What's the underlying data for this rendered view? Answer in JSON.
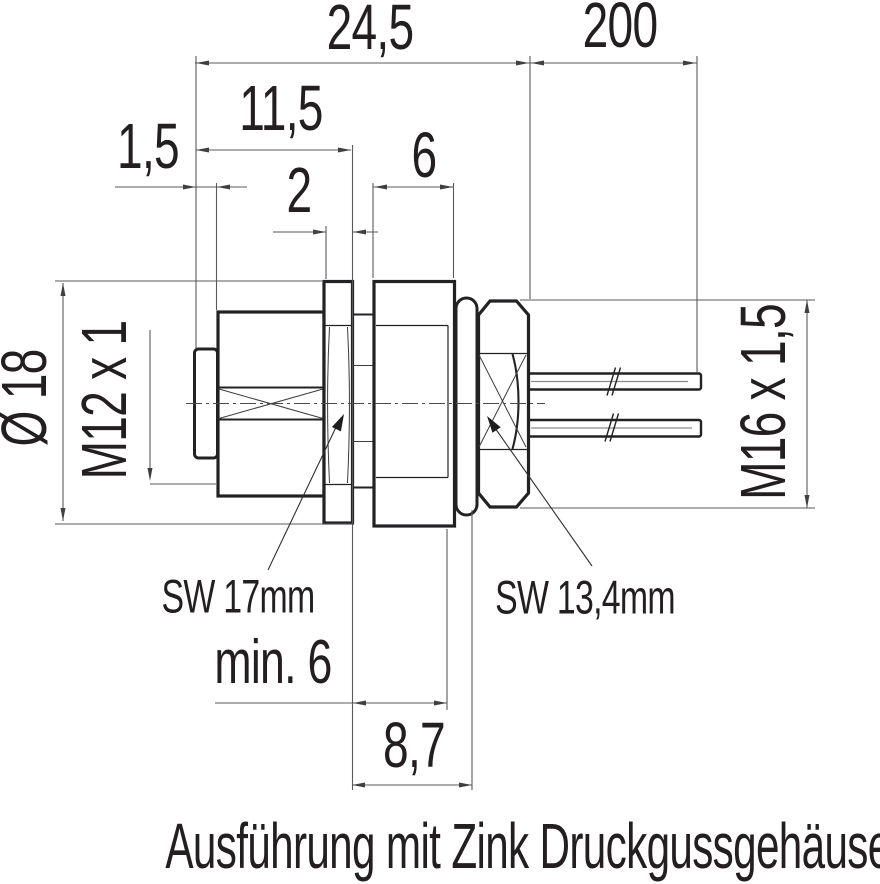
{
  "caption": "Ausführung mit Zink Druckgussgehäuse",
  "labels": {
    "overall_length": "24,5",
    "wire_length": "200",
    "head_length": "11,5",
    "rim_width": "1,5",
    "flange_width": "2",
    "thread_length": "6",
    "diameter": "Ø 18",
    "front_thread": "M12 x 1",
    "mount_thread": "M16 x 1,5",
    "wrench_flange": "SW 17mm",
    "wrench_nut": "SW 13,4mm",
    "min_panel": "min. 6",
    "nut_length": "8,7"
  },
  "colors": {
    "part": "#222224",
    "line": "#59595c",
    "text": "#231f20",
    "bg": "#ffffff"
  }
}
